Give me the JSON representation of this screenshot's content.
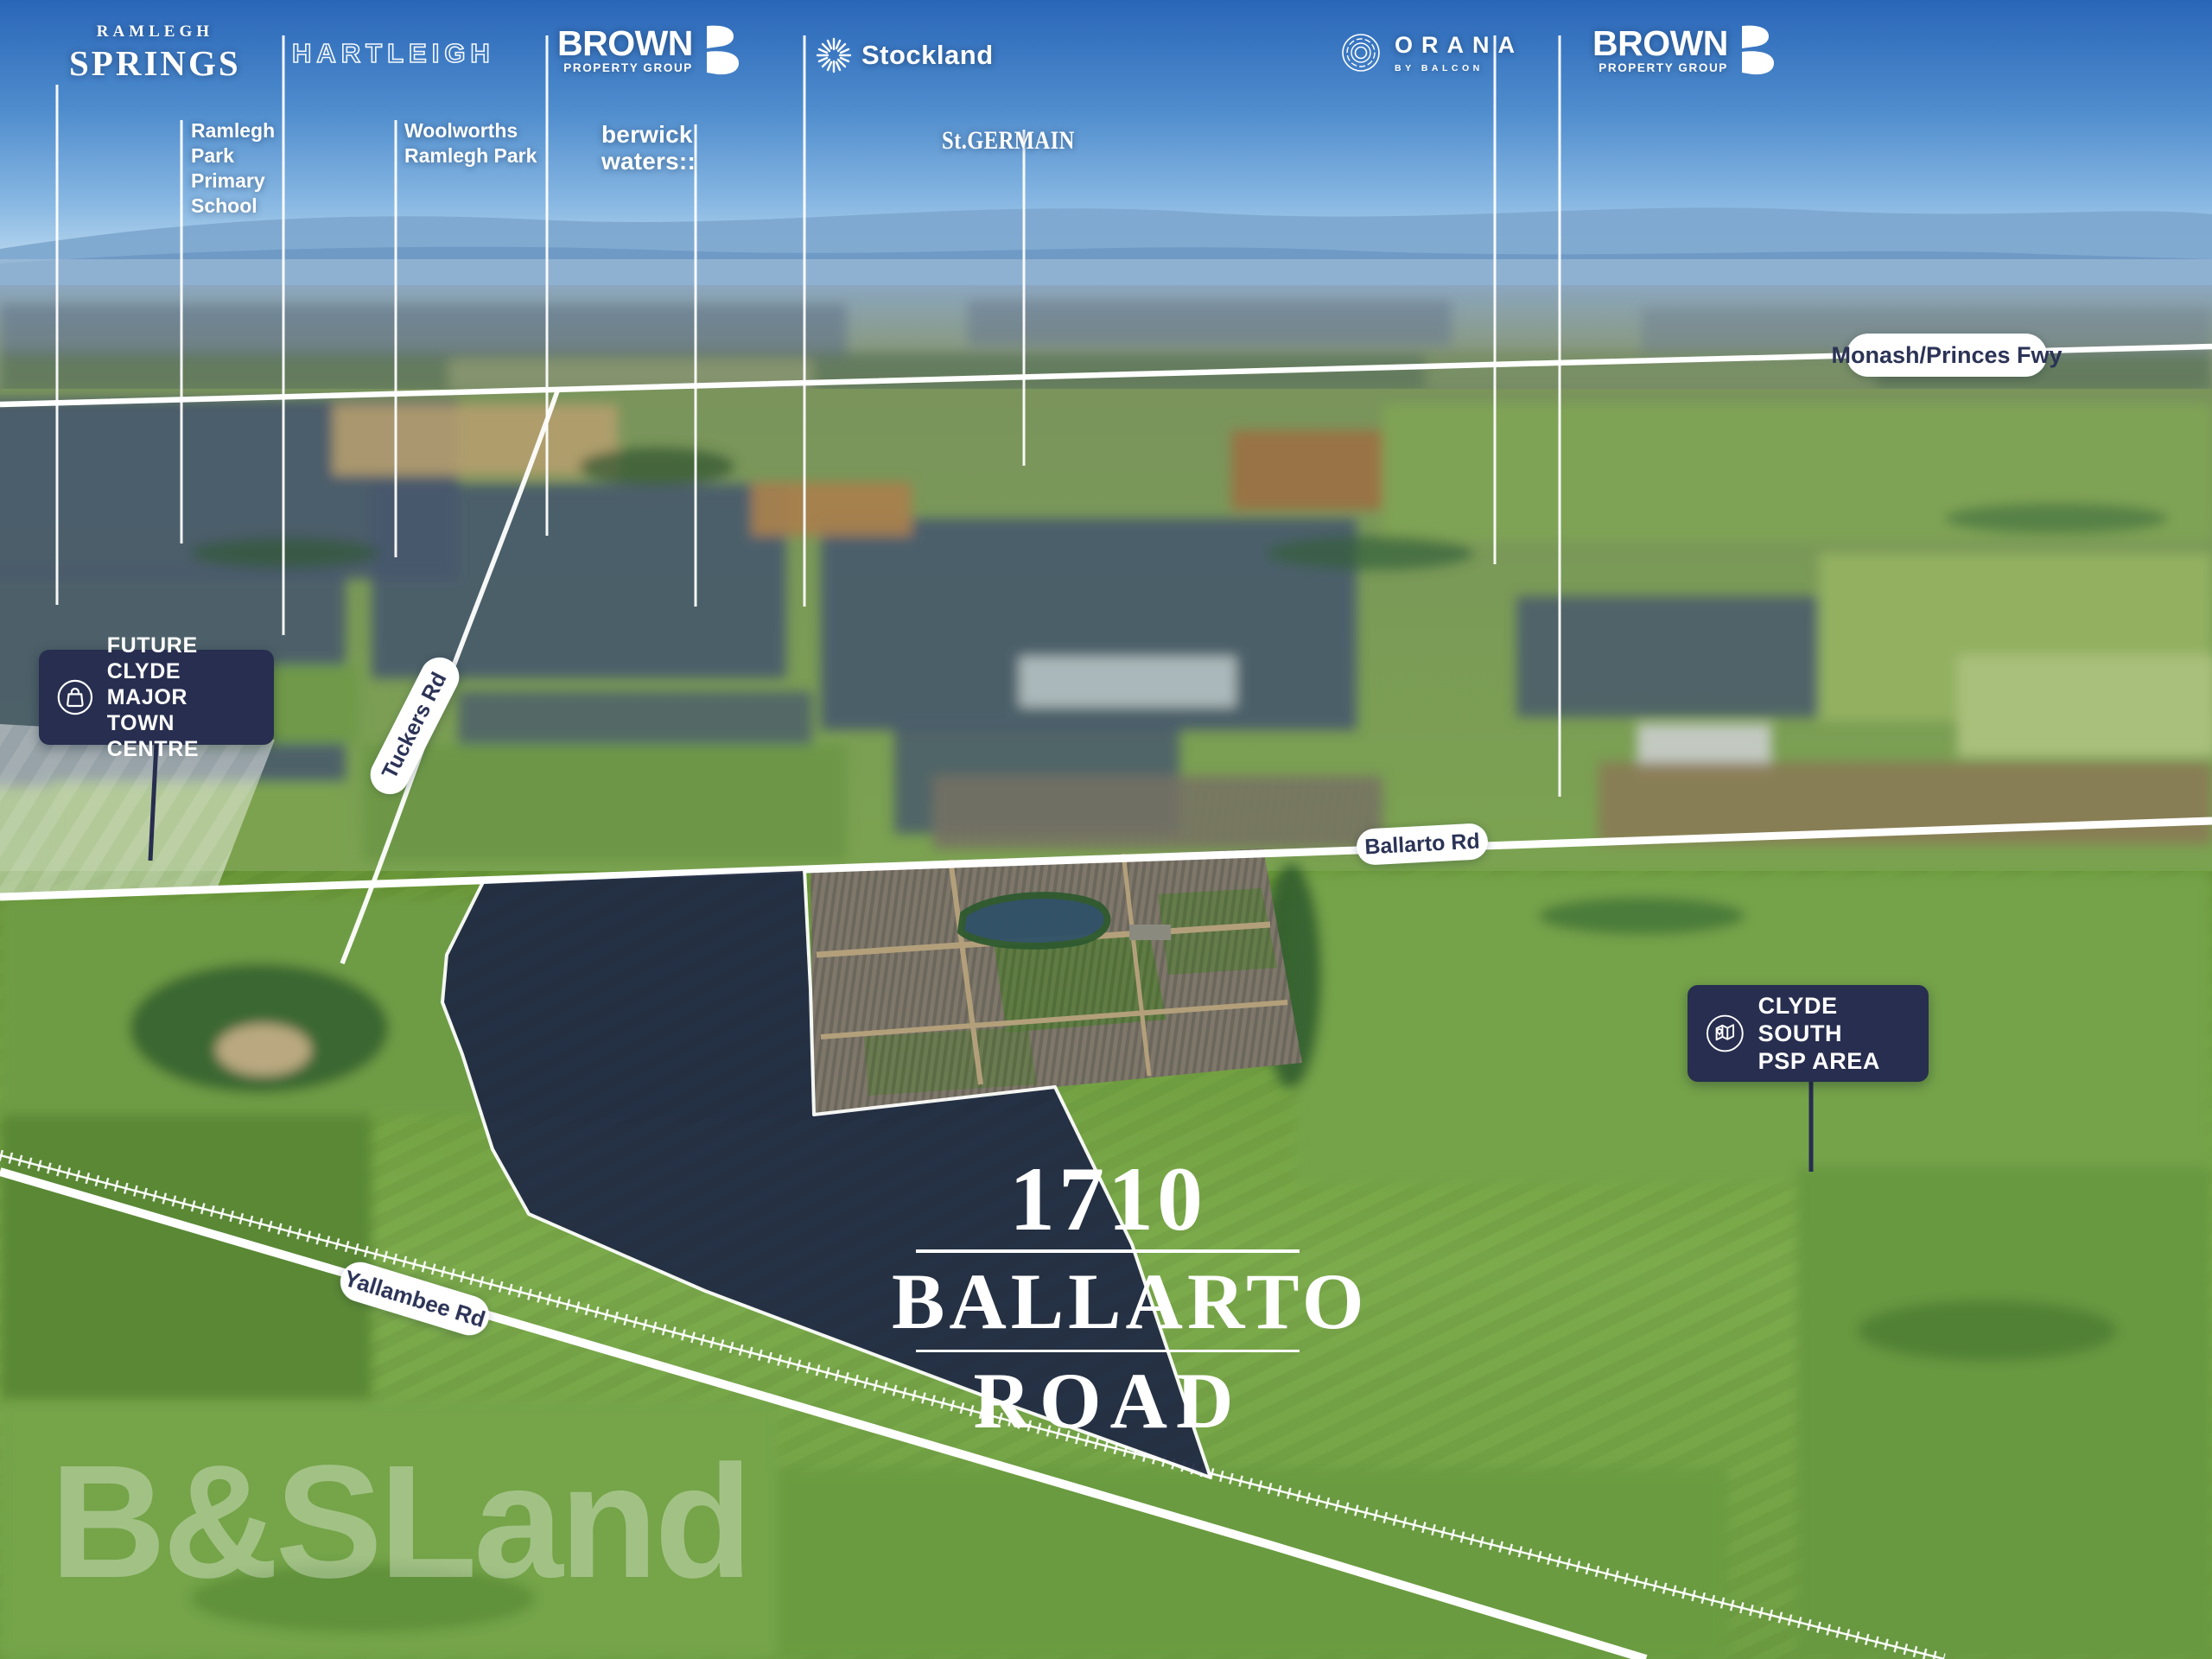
{
  "scene": {
    "watermark": "B&SLand",
    "site_label": {
      "line1": "1710",
      "line2": "BALLARTO",
      "line3": "ROAD"
    },
    "logos": {
      "ramlegh_springs": {
        "top": "RAMLEGH",
        "bottom": "SPRINGS"
      },
      "hartleigh": {
        "label": "HARTLEIGH"
      },
      "brown_left": {
        "name": "BROWN",
        "sub": "PROPERTY GROUP",
        "monogram": "B"
      },
      "stockland": {
        "label": "Stockland"
      },
      "orana": {
        "label": "ORANA",
        "sub": "BY BALCON"
      },
      "brown_right": {
        "name": "BROWN",
        "sub": "PROPERTY GROUP",
        "monogram": "B"
      }
    },
    "labels": {
      "primary_school": {
        "lines": [
          "Ramlegh",
          "Park",
          "Primary",
          "School"
        ]
      },
      "woolworths": {
        "lines": [
          "Woolworths",
          "Ramlegh Park"
        ]
      },
      "berwick_waters": {
        "lines": [
          "berwick",
          "waters::"
        ]
      },
      "st_germain": {
        "label": "St.GERMAIN"
      }
    },
    "road_badges": {
      "monash": "Monash/Princes Fwy",
      "tuckers": "Tuckers Rd",
      "ballarto": "Ballarto Rd",
      "yallambee": "Yallambee Rd"
    },
    "callouts": {
      "future_clyde": {
        "icon": "shopping-bag-icon",
        "lines": [
          "FUTURE CLYDE",
          "MAJOR TOWN",
          "CENTRE"
        ]
      },
      "clyde_south": {
        "icon": "map-pin-icon",
        "lines": [
          "CLYDE SOUTH",
          "PSP AREA"
        ]
      }
    },
    "colors": {
      "badge_navy": "#272e4f",
      "site_navy": "#202a45",
      "pill_text_navy": "#2b3356",
      "line_white": "#ffffff"
    }
  }
}
